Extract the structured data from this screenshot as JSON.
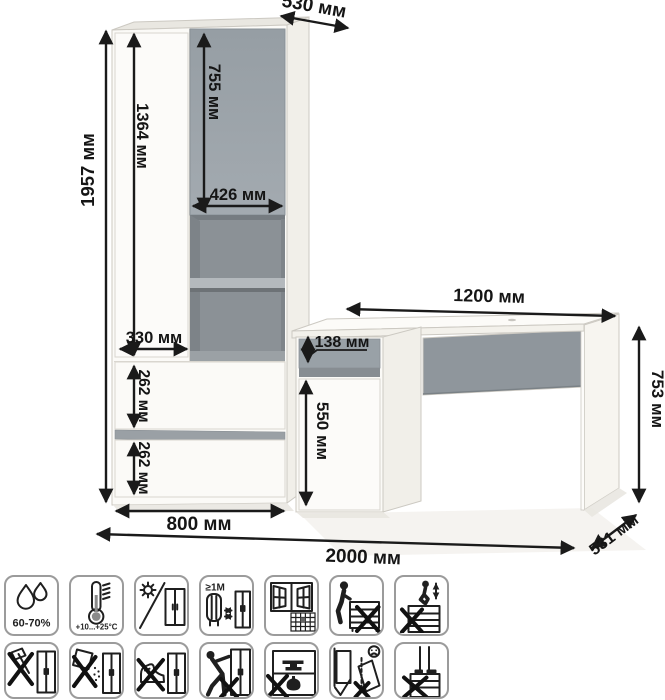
{
  "diagram": {
    "type": "furniture-dimension-diagram",
    "wardrobe": {
      "depth": "530 мм",
      "total_height": "1957 мм",
      "left_door_height": "1364 мм",
      "top_door_height": "755 мм",
      "top_door_width": "426 мм",
      "left_door_width": "330 мм",
      "upper_drawer_height": "262 мм",
      "lower_drawer_height": "262 мм",
      "width": "800 мм"
    },
    "desk": {
      "width": "1200 мм",
      "height": "753 мм",
      "depth": "531 мм",
      "drawer_height": "138 мм",
      "door_height": "550 мм"
    },
    "total_width": "2000 мм",
    "colors": {
      "accent_gray": "#99a1a7",
      "interior_gray": "#8b9196",
      "dimension_line": "#1a1a1a",
      "panel_white": "#fbfaf7"
    }
  },
  "care_icons": {
    "row1": [
      {
        "name": "humidity-icon",
        "label": "60-70%"
      },
      {
        "name": "temperature-icon",
        "label": "+10...+25°C"
      },
      {
        "name": "no-direct-sunlight-icon",
        "label": ""
      },
      {
        "name": "heat-distance-icon",
        "label": "≥1M"
      },
      {
        "name": "ventilation-icon",
        "label": ""
      },
      {
        "name": "no-sitting-icon",
        "label": ""
      },
      {
        "name": "no-jumping-icon",
        "label": ""
      }
    ],
    "row2": [
      {
        "name": "no-sharp-tools-icon"
      },
      {
        "name": "no-impact-icon"
      },
      {
        "name": "no-kicking-icon"
      },
      {
        "name": "no-pushing-icon"
      },
      {
        "name": "no-overloading-icon"
      },
      {
        "name": "anti-tip-anchor-icon"
      },
      {
        "name": "no-standing-icon"
      }
    ]
  }
}
